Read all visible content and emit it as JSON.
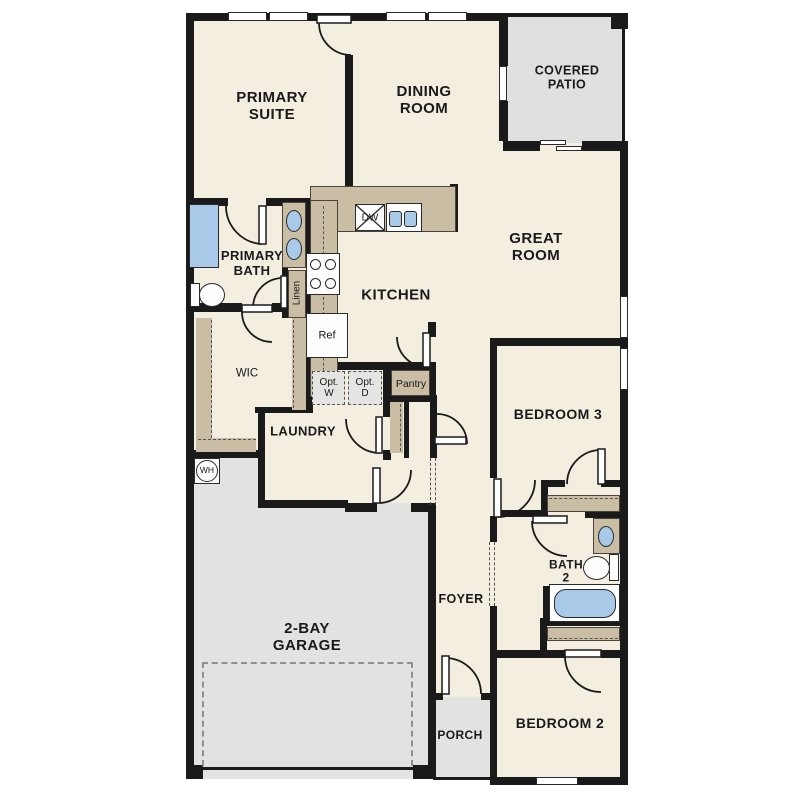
{
  "palette": {
    "wall": "#1a1a1a",
    "floor": "#f4eee1",
    "outdoor_gray": "#e2e2e0",
    "cabinet_tan": "#c9bda4",
    "fixture_blue": "#a9c9e9"
  },
  "rooms": {
    "primary_suite": "PRIMARY\nSUITE",
    "dining_room": "DINING\nROOM",
    "covered_patio": "COVERED\nPATIO",
    "great_room": "GREAT\nROOM",
    "primary_bath": "PRIMARY\nBATH",
    "kitchen": "KITCHEN",
    "wic": "WIC",
    "laundry": "LAUNDRY",
    "pantry": "Pantry",
    "bedroom_3": "BEDROOM 3",
    "bath_2": "BATH\n2",
    "foyer": "FOYER",
    "garage": "2-BAY\nGARAGE",
    "porch": "PORCH",
    "bedroom_2": "BEDROOM 2"
  },
  "fixtures": {
    "dishwasher": "DW",
    "refrigerator": "Ref",
    "linen": "Linen",
    "opt_washer": "Opt.\nW",
    "opt_dryer": "Opt.\nD",
    "water_heater": "WH"
  }
}
